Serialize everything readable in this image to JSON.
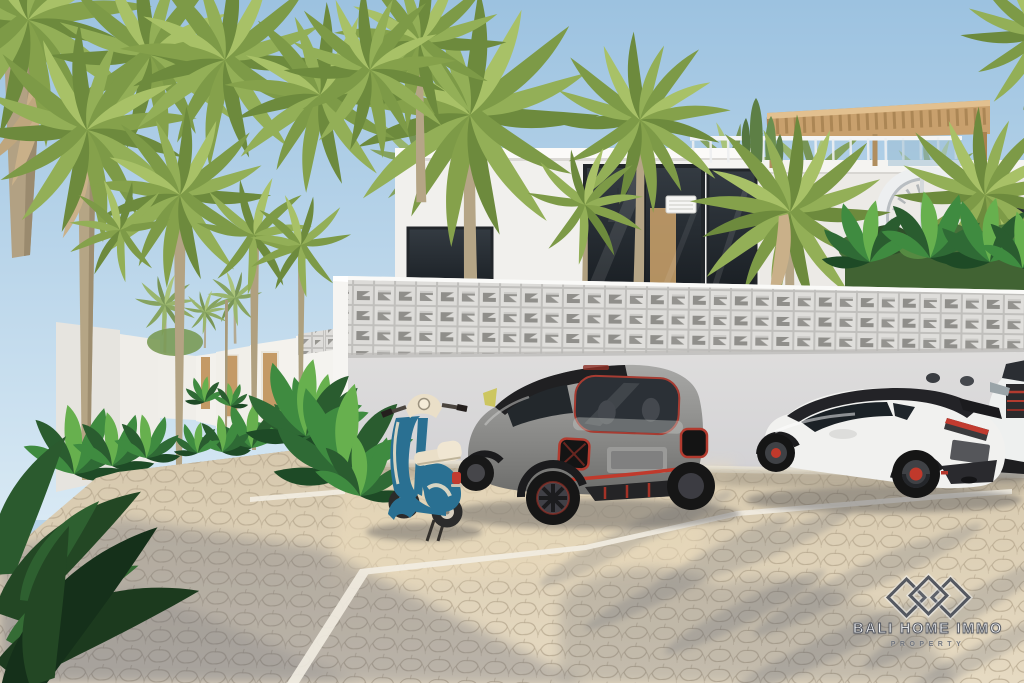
{
  "watermark": {
    "brand": "BALI HOME IMMO",
    "tagline": "PROPERTY",
    "icon": "triple-diamond-logo"
  },
  "colors": {
    "sky_top": "#9cc2e0",
    "sky_horizon": "#d8e9f4",
    "villa_white": "#f1f0ed",
    "breeze_block": "#d9d8d5",
    "pavement_sun": "#e0d3ba",
    "shadow_cool": "#545a6e",
    "palm_green": "#8ba94f",
    "hedge_green": "#416333",
    "wood": "#c8a06d",
    "vespa_teal": "#2a7092",
    "vespa_cream": "#eadfc8",
    "smart_gray": "#8e8e8c",
    "yaris_white": "#f1f1ef",
    "accent_red": "#c03a2c",
    "logo_slate": "#4b505b"
  }
}
